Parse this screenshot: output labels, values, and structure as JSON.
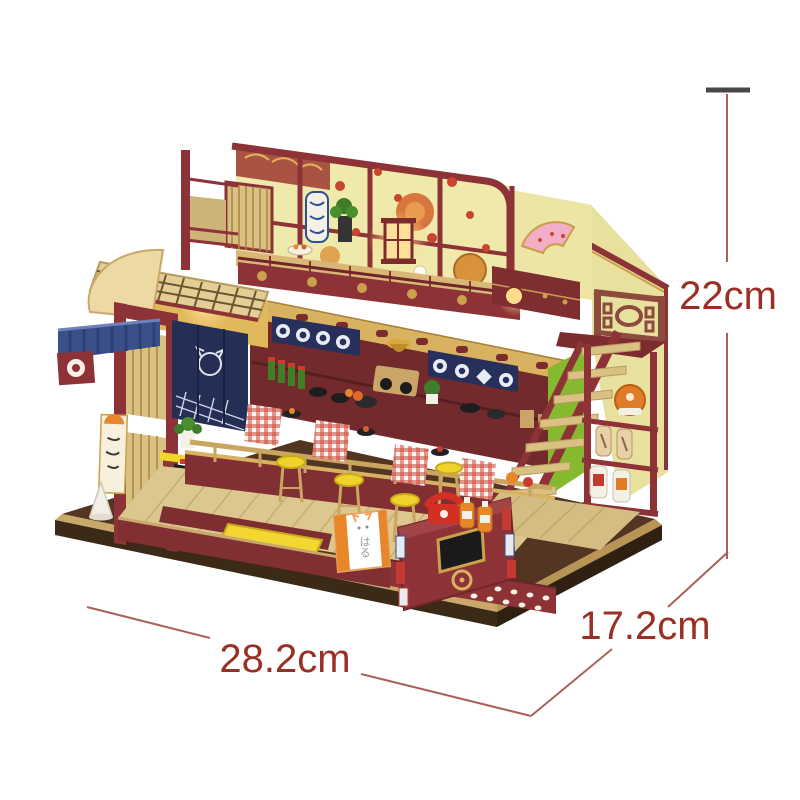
{
  "image": {
    "alt_text": "Product photo of a DIY miniature wooden dollhouse kit shaped like a two-story Japanese sushi shop, shown on a white background with printed size dimensions",
    "background_color": "#ffffff"
  },
  "annotations": {
    "height_label": "22cm",
    "width_label": "28.2cm",
    "depth_label": "17.2cm",
    "line_color": "#a8625b",
    "label_color": "#9a2f23",
    "cap_color": "#474747"
  },
  "signs": {
    "front_box_sign_text": "はる"
  },
  "palette": {
    "maroon": "#8d3237",
    "deep_maroon": "#6f262b",
    "gold_beam": "#d8b261",
    "cream_wall": "#efe9ab",
    "wood_tan": "#d9c083",
    "floor_wood": "#dcc88f",
    "navy_curtain": "#27305a",
    "awning_blue": "#3b4f88",
    "stool_yellow": "#efd32c",
    "stair_green": "#85b92e",
    "lantern_glow": "#ffd98c",
    "base_wood": "#c9a86a",
    "accent_red": "#c8452e",
    "sign_orange": "#e8872a",
    "porcelain_white": "#f4f0e6",
    "fan_pink": "#f3aec7"
  }
}
